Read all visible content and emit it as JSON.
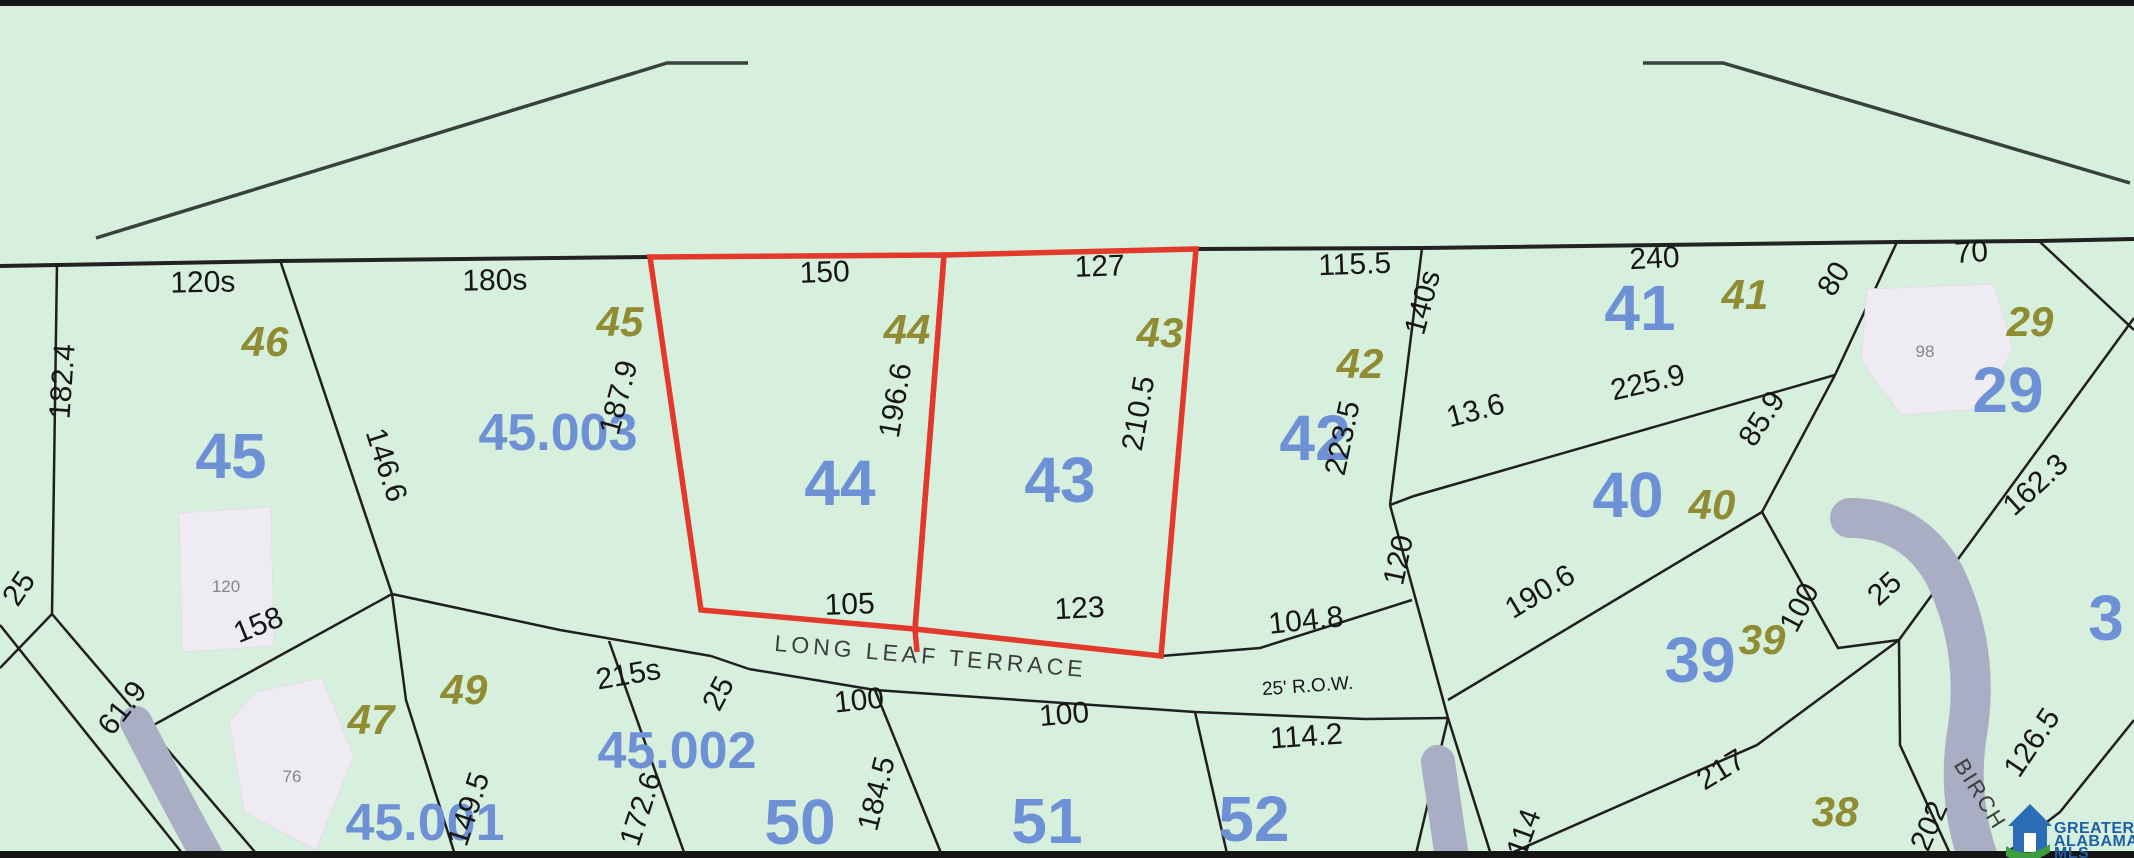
{
  "map": {
    "colors": {
      "background": "#d7efdd",
      "parcel_line": "#1f1f1f",
      "highlight_red": "#e2392c",
      "lot_number_blue": "#6e90d5",
      "lot_number_olive": "#8f8c33",
      "road_gray": "#a9aec4",
      "building_fill": "#eeebf2"
    },
    "streets": {
      "long_leaf": "LONG LEAF TERRACE",
      "birch": "BIRCH",
      "row": "25' R.O.W."
    },
    "blue_lots": [
      "45",
      "44",
      "43",
      "42",
      "41",
      "40",
      "39",
      "29",
      "50",
      "51",
      "52",
      "3"
    ],
    "olive_lots": [
      "46",
      "45",
      "44",
      "43",
      "42",
      "41",
      "40",
      "39",
      "29",
      "49",
      "47",
      "38"
    ],
    "parcels": [
      "45.003",
      "45.001",
      "45.002"
    ],
    "houses": [
      "120",
      "76",
      "98"
    ],
    "dims": [
      "120s",
      "180s",
      "150",
      "127",
      "115.5",
      "140s",
      "240",
      "80",
      "70",
      "182.4",
      "146.6",
      "187.9",
      "196.6",
      "210.5",
      "223.5",
      "13.6",
      "225.9",
      "85.9",
      "158",
      "61.9",
      "25",
      "215s",
      "25",
      "105",
      "123",
      "104.8",
      "114.2",
      "100",
      "100",
      "184.5",
      "172.6",
      "149.5",
      "120",
      "190.6",
      "100",
      "217",
      "114",
      "162.3",
      "126.5",
      "202",
      "25"
    ]
  },
  "logo": {
    "line1": "GREATER",
    "line2": "ALABAMA",
    "line3": "MLS"
  }
}
